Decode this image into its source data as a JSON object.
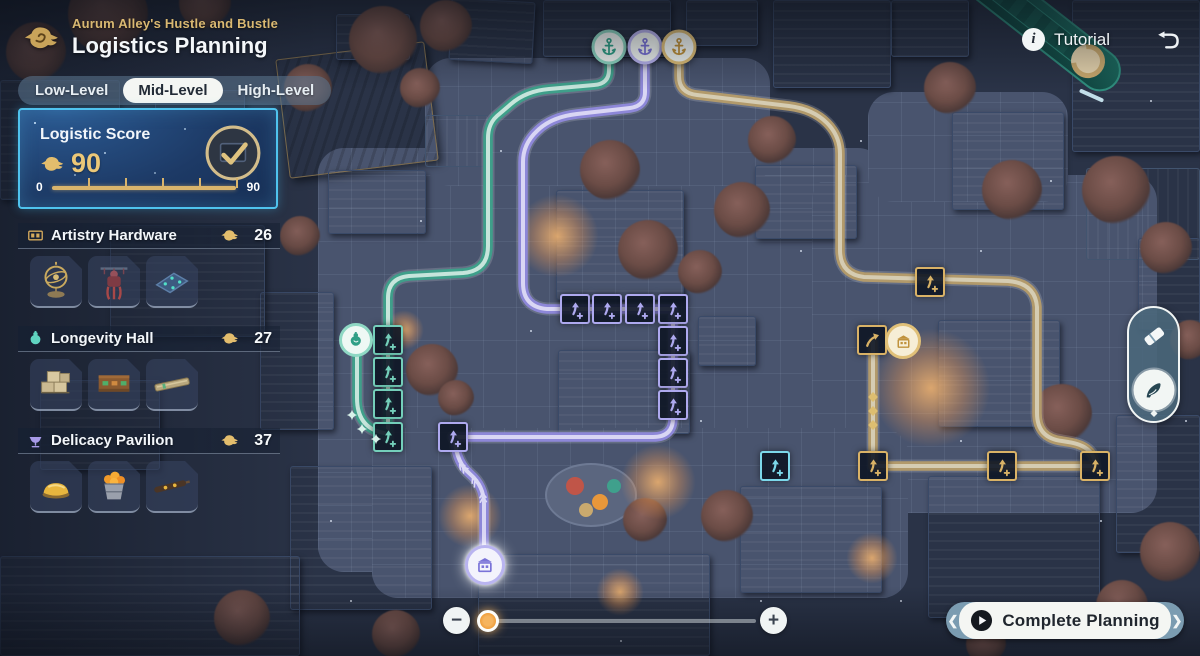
{
  "header": {
    "subtitle": "Aurum Alley's Hustle and Bustle",
    "title": "Logistics Planning"
  },
  "tabs": {
    "items": [
      {
        "label": "Low-Level",
        "active": false
      },
      {
        "label": "Mid-Level",
        "active": true
      },
      {
        "label": "High-Level",
        "active": false
      }
    ]
  },
  "score_panel": {
    "title": "Logistic Score",
    "value": "90",
    "bar_start": "0",
    "bar_end": "90"
  },
  "sections": [
    {
      "id": "artistry-hardware",
      "icon": "chest-icon",
      "name": "Artistry Hardware",
      "count": "26",
      "items": [
        "armillary-sphere",
        "marionette",
        "craft-mat"
      ]
    },
    {
      "id": "longevity-hall",
      "icon": "gourd-icon",
      "name": "Longevity Hall",
      "count": "27",
      "items": [
        "crate-stack",
        "goods-shelf",
        "long-plank"
      ]
    },
    {
      "id": "delicacy-pavilion",
      "icon": "bowl-icon",
      "name": "Delicacy Pavilion",
      "count": "37",
      "items": [
        "golden-pastry",
        "fruit-basket",
        "skewer-board"
      ]
    }
  ],
  "topbar": {
    "tutorial_label": "Tutorial",
    "tutorial_glyph": "i"
  },
  "bottom": {
    "complete_label": "Complete Planning",
    "zoom_out": "−",
    "zoom_in": "+",
    "cap_left": "❮",
    "cap_right": "❯"
  },
  "colors": {
    "gold": "#d6b26d",
    "teal": "#55b9a2",
    "purple": "#9d98e4",
    "cyan": "#7cd8ea",
    "panel_border": "#4fc3ee"
  },
  "map": {
    "anchors": [
      {
        "color": "teal",
        "x": 609,
        "y": 47
      },
      {
        "color": "purple",
        "x": 645,
        "y": 47
      },
      {
        "color": "gold",
        "x": 679,
        "y": 47
      }
    ],
    "paths": [
      {
        "color": "teal",
        "d": "M609 58 L609 70 Q609 84 594 85 L549 89 Q526 91 511 104 L497 116 Q488 124 488 138 L488 246 Q488 271 463 273 L409 276 Q388 278 388 298 L388 437"
      },
      {
        "color": "teal",
        "d": "M357 356 L357 398 Q357 428 384 433"
      },
      {
        "color": "purple",
        "d": "M645 58 L645 92 Q645 106 630 108 L577 114 Q551 117 537 131 Q523 144 523 162 L523 283 Q523 307 547 309 L575 309"
      },
      {
        "color": "purple",
        "d": "M575 309 L673 309 L673 418 Q673 437 653 437 L453 437"
      },
      {
        "color": "purple",
        "d": "M455 442 Q457 463 470 474 Q484 486 484 504 L484 548"
      },
      {
        "color": "gold",
        "d": "M679 58 L679 76 Q679 93 697 95 L789 106 Q813 109 827 123 Q840 136 840 154 L840 250 Q840 274 864 277 L1008 281 Q1035 283 1037 307 L1037 413 Q1037 438 1062 441 L1068 442 Q1095 446 1095 466"
      },
      {
        "color": "gold",
        "d": "M1095 466 L873 466 L873 342"
      }
    ],
    "nodes": [
      {
        "color": "teal",
        "x": 388,
        "y": 340
      },
      {
        "color": "teal",
        "x": 388,
        "y": 372
      },
      {
        "color": "teal",
        "x": 388,
        "y": 404
      },
      {
        "color": "teal",
        "x": 388,
        "y": 437
      },
      {
        "color": "purple",
        "x": 575,
        "y": 309
      },
      {
        "color": "purple",
        "x": 607,
        "y": 309
      },
      {
        "color": "purple",
        "x": 640,
        "y": 309
      },
      {
        "color": "purple",
        "x": 673,
        "y": 309
      },
      {
        "color": "purple",
        "x": 673,
        "y": 341
      },
      {
        "color": "purple",
        "x": 673,
        "y": 373
      },
      {
        "color": "purple",
        "x": 673,
        "y": 405
      },
      {
        "color": "purple",
        "x": 453,
        "y": 437
      },
      {
        "color": "gold",
        "x": 930,
        "y": 282
      },
      {
        "color": "gold",
        "x": 872,
        "y": 340,
        "icon": "check"
      },
      {
        "color": "gold",
        "x": 873,
        "y": 466
      },
      {
        "color": "gold",
        "x": 1002,
        "y": 466
      },
      {
        "color": "gold",
        "x": 1095,
        "y": 466
      },
      {
        "color": "cyan",
        "x": 775,
        "y": 466
      }
    ],
    "markers": [
      {
        "type": "gourd",
        "color": "teal",
        "x": 356,
        "y": 340
      },
      {
        "type": "stall",
        "color": "gold",
        "x": 903,
        "y": 341
      },
      {
        "type": "stall",
        "color": "purple",
        "x": 485,
        "y": 565
      }
    ],
    "decor": [
      {
        "type": "diamond",
        "color": "gold",
        "x": 873,
        "y": 397,
        "rot": 0
      },
      {
        "type": "diamond",
        "color": "gold",
        "x": 873,
        "y": 411,
        "rot": 0
      },
      {
        "type": "diamond",
        "color": "gold",
        "x": 873,
        "y": 425,
        "rot": 0
      },
      {
        "type": "chevron",
        "color": "purple",
        "x": 463,
        "y": 468,
        "rot": 225
      },
      {
        "type": "chevron",
        "color": "purple",
        "x": 475,
        "y": 482,
        "rot": 240
      },
      {
        "type": "chevron",
        "color": "purple",
        "x": 483,
        "y": 498,
        "rot": 265
      },
      {
        "type": "sparkle",
        "color": "teal",
        "x": 352,
        "y": 415,
        "rot": 0
      },
      {
        "type": "sparkle",
        "color": "teal",
        "x": 362,
        "y": 429,
        "rot": 0
      },
      {
        "type": "sparkle",
        "color": "teal",
        "x": 376,
        "y": 439,
        "rot": 0
      }
    ]
  }
}
